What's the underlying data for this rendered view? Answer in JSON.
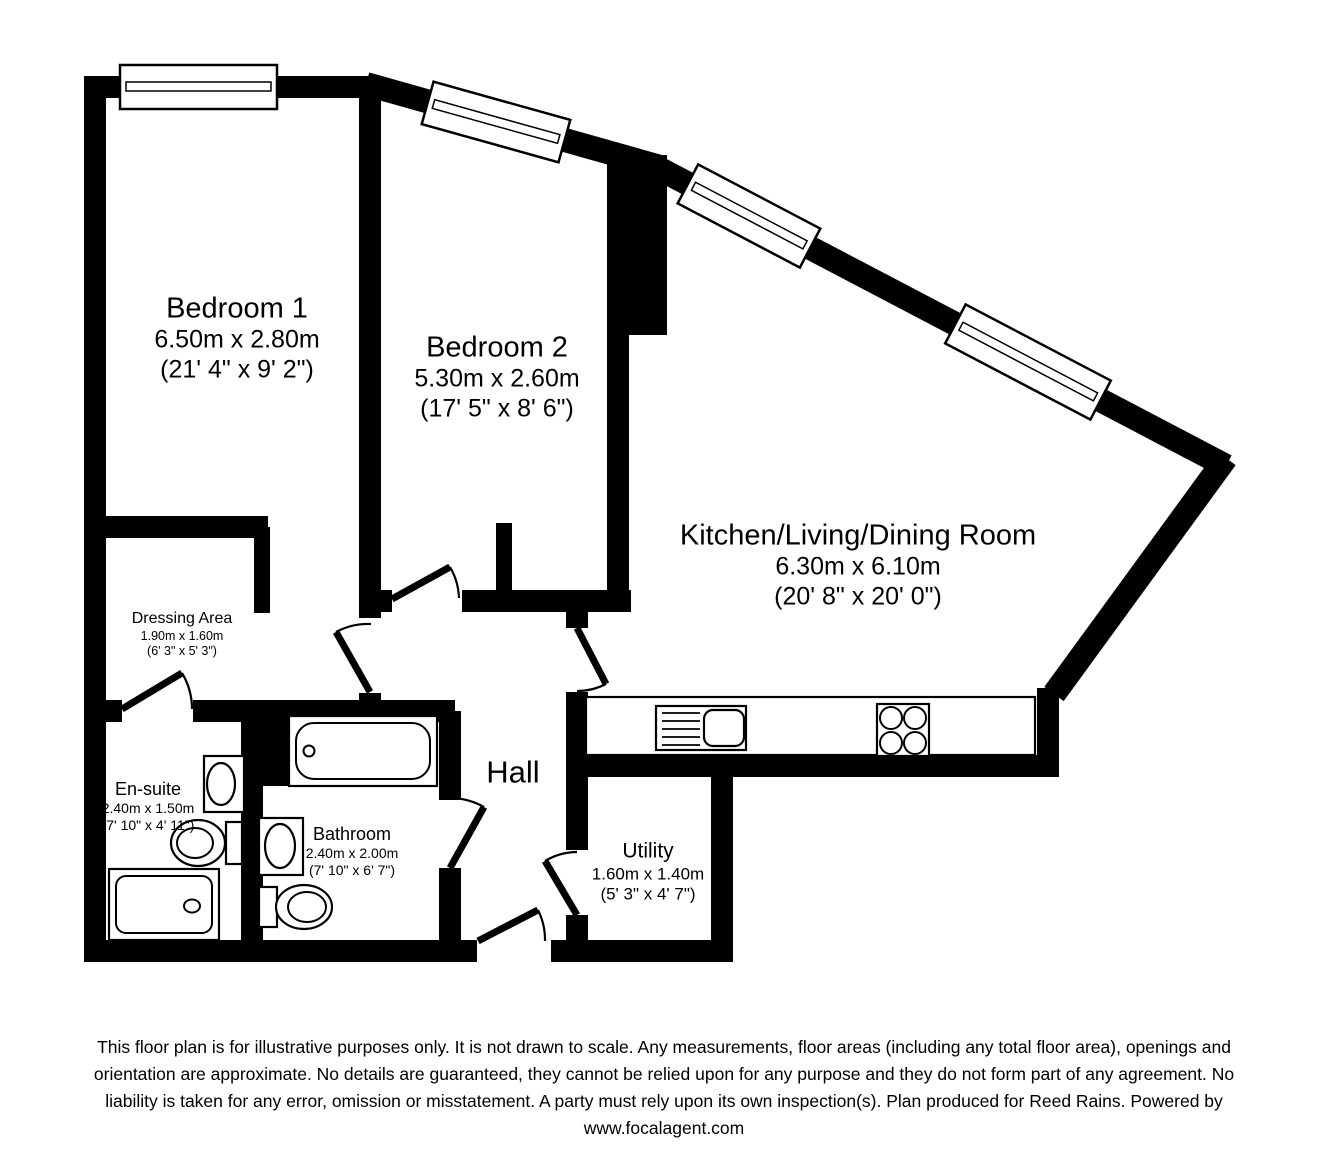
{
  "plan": {
    "rooms": {
      "bedroom1": {
        "name": "Bedroom 1",
        "metric": "6.50m x 2.80m",
        "imperial": "(21' 4\" x 9' 2\")"
      },
      "bedroom2": {
        "name": "Bedroom 2",
        "metric": "5.30m x 2.60m",
        "imperial": "(17' 5\" x 8' 6\")"
      },
      "kitchen": {
        "name": "Kitchen/Living/Dining Room",
        "metric": "6.30m x 6.10m",
        "imperial": "(20' 8\" x 20' 0\")"
      },
      "dressing": {
        "name": "Dressing Area",
        "metric": "1.90m x 1.60m",
        "imperial": "(6' 3\" x 5' 3\")"
      },
      "ensuite": {
        "name": "En-suite",
        "metric": "2.40m x 1.50m",
        "imperial": "(7' 10\" x 4' 11\")"
      },
      "bathroom": {
        "name": "Bathroom",
        "metric": "2.40m x 2.00m",
        "imperial": "(7' 10\" x 6' 7\")"
      },
      "hall": {
        "name": "Hall"
      },
      "utility": {
        "name": "Utility",
        "metric": "1.60m x 1.40m",
        "imperial": "(5' 3\" x 4' 7\")"
      }
    },
    "colors": {
      "wall": "#000000",
      "background": "#ffffff"
    },
    "disclaimer": {
      "lines": [
        "This floor plan is for illustrative purposes only. It is not drawn to scale. Any measurements, floor areas (including any total floor area), openings and",
        "orientation are approximate. No details are guaranteed, they cannot be relied upon for any purpose and they do not form part of any agreement. No",
        "liability is taken for any error, omission or misstatement. A party must rely upon its own inspection(s). Plan produced for Reed Rains. Powered by",
        "www.focalagent.com"
      ]
    }
  }
}
